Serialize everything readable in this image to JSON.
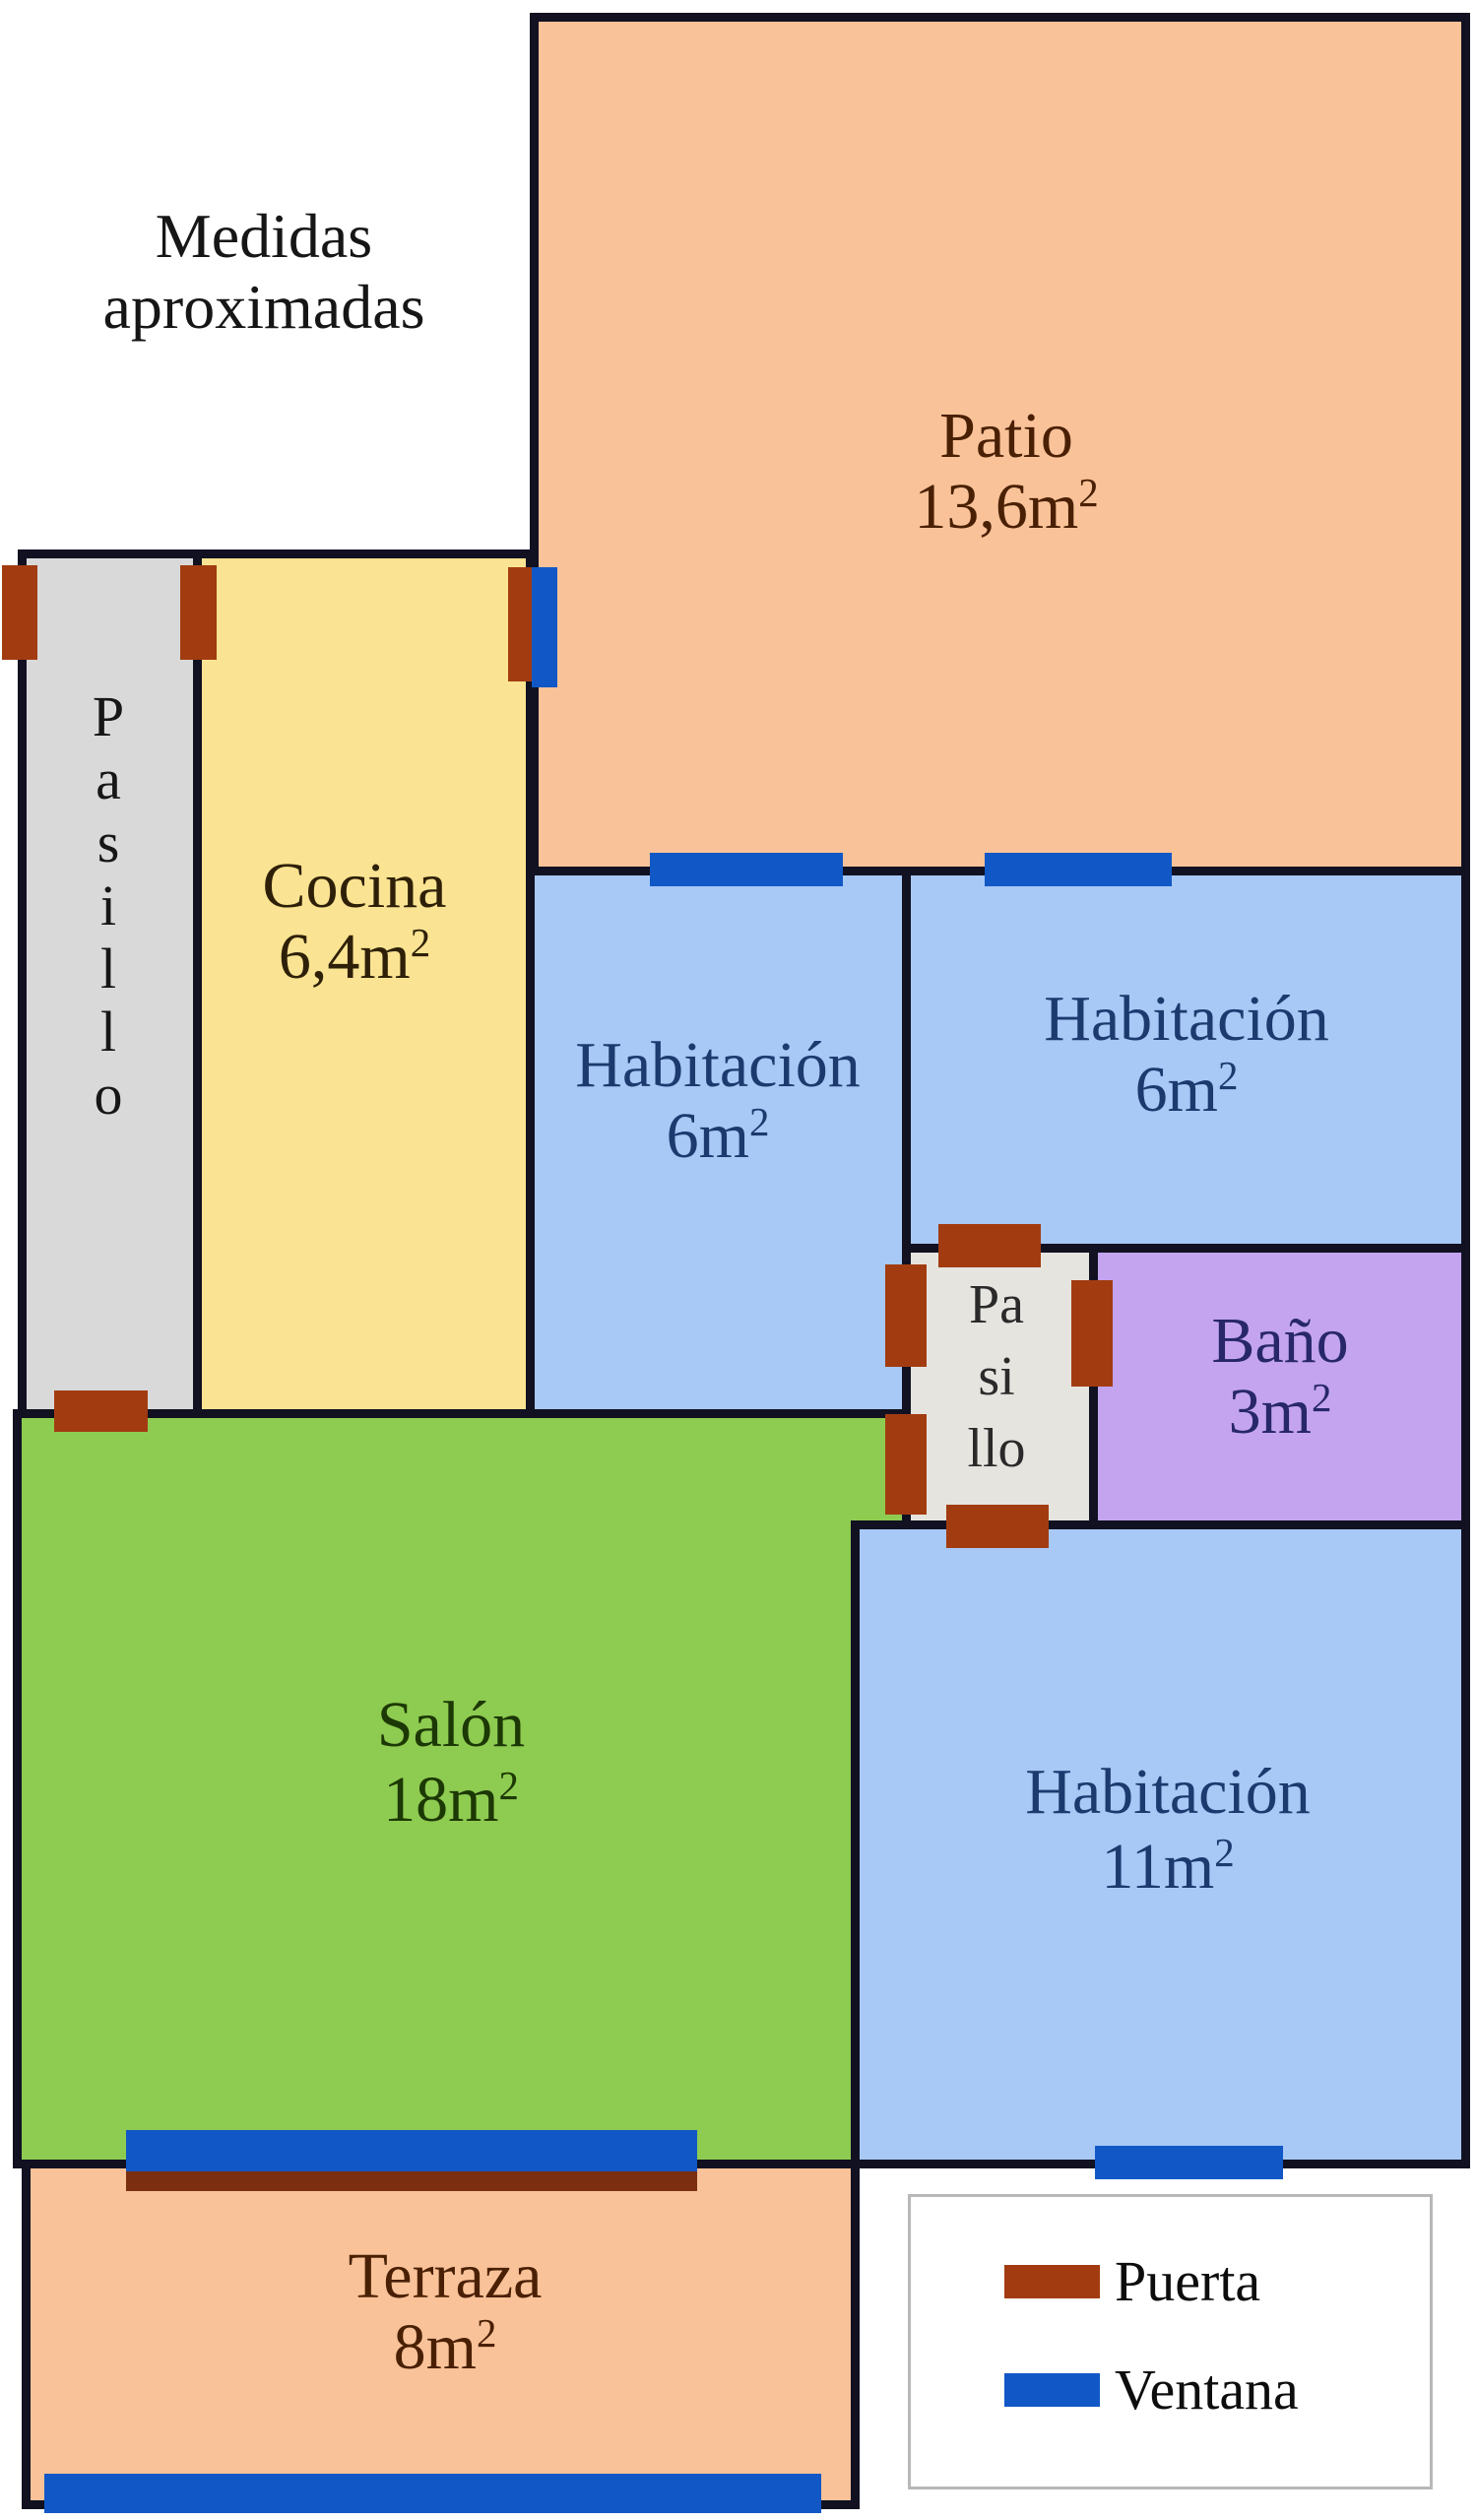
{
  "title": {
    "line1": "Medidas",
    "line2": "aproximadas"
  },
  "rooms": {
    "patio": {
      "name": "Patio",
      "area_base": "13,6m",
      "area_sup": "2"
    },
    "cocina": {
      "name": "Cocina",
      "area_base": "6,4m",
      "area_sup": "2"
    },
    "pasillo_left": {
      "letters": [
        "P",
        "a",
        "s",
        "i",
        "l",
        "l",
        "o"
      ]
    },
    "hab6_left": {
      "name": "Habitación",
      "area_base": "6m",
      "area_sup": "2"
    },
    "hab6_right": {
      "name": "Habitación",
      "area_base": "6m",
      "area_sup": "2"
    },
    "pasillo_small": {
      "line1": "Pa",
      "line2": "si",
      "line3": "llo"
    },
    "bano": {
      "name": "Baño",
      "area_base": "3m",
      "area_sup": "2"
    },
    "salon": {
      "name": "Salón",
      "area_base": "18m",
      "area_sup": "2"
    },
    "hab11": {
      "name": "Habitación",
      "area_base": "11m",
      "area_sup": "2"
    },
    "terraza": {
      "name": "Terraza",
      "area_base": "8m",
      "area_sup": "2"
    }
  },
  "legend": {
    "door_label": "Puerta",
    "window_label": "Ventana"
  },
  "colors": {
    "wall": "#111122",
    "door": "#A23C10",
    "window": "#1158C6",
    "window-shadow": "#7B2F10",
    "patio-fill": "#F9C298",
    "cocina-fill": "#FAE392",
    "pasillo-fill": "#D9D9D9",
    "pasillo-small-fill": "#E6E4DE",
    "hab-fill": "#A8C8F6",
    "bano-fill": "#C4A4EE",
    "salon-fill": "#8ECB51",
    "terraza-fill": "#F9C298",
    "hab-text": "#1C3A6E",
    "bano-text": "#27276A",
    "salon-text": "#1C3804",
    "patio-text": "#4A2005",
    "cocina-text": "#2E2008"
  }
}
